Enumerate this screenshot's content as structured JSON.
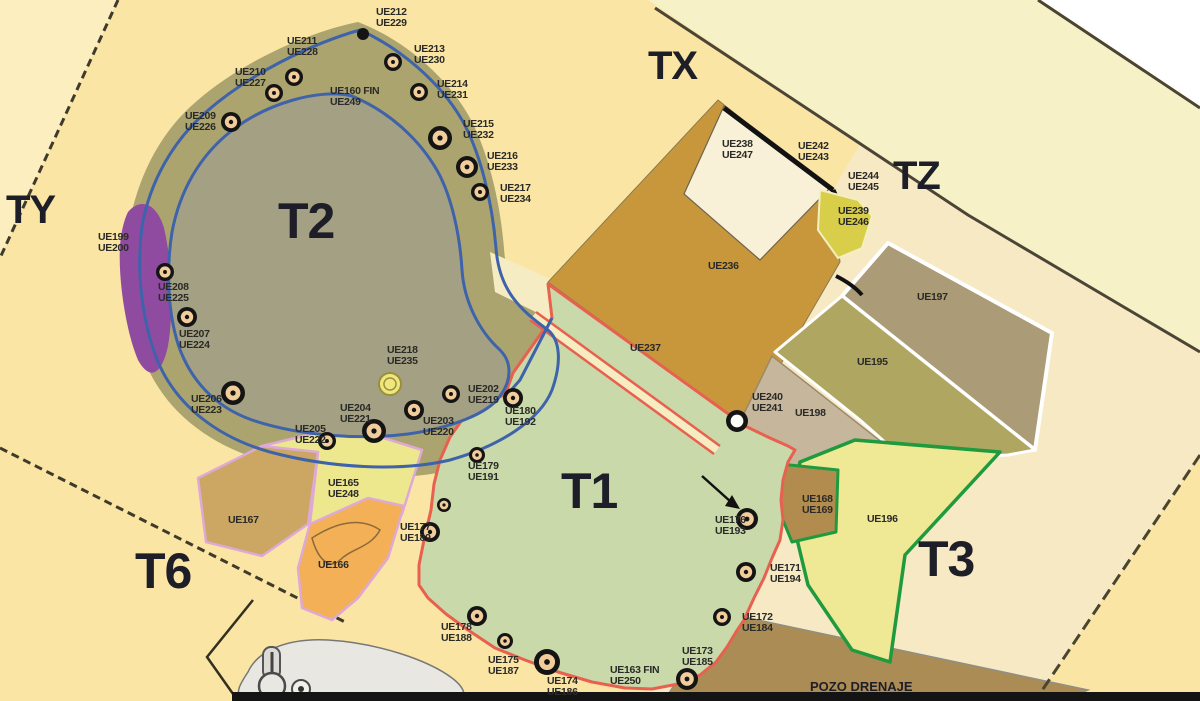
{
  "map": {
    "title": "archaeological-excavation-plan",
    "palette": {
      "background": "#FBE5A4",
      "background_light": "#FCEEBF",
      "outer_band": "#F6F1C6",
      "cream_area": "#F8E9C5",
      "t2_olive": "#ACA46E",
      "t2_inner": "#A4A083",
      "t2_outline_blue": "#3E63AA",
      "t1_green": "#C9D9A9",
      "t1_outline_red": "#E8604F",
      "purple_patch": "#8F4B9F",
      "ue236_gold": "#C9973B",
      "ue197_brown": "#AB9B76",
      "ue195_olive": "#AFA661",
      "ue198_tan": "#C6B69C",
      "ue196_yellow": "#EFE895",
      "green_outline": "#1F9A3F",
      "ue168_brown": "#B28C4E",
      "pozo_brown": "#AC8C55",
      "ue167_tan": "#CBA763",
      "ue165_yellow": "#EDE88E",
      "ue166_orange": "#F4B057",
      "pink_outline": "#DDA9D6",
      "feature_fill": "#F2CD9C",
      "label_color": "#2A2A28"
    },
    "zone_labels": [
      {
        "label": "T1",
        "x": 561,
        "y": 468,
        "size": 50
      },
      {
        "label": "T2",
        "x": 278,
        "y": 198,
        "size": 50
      },
      {
        "label": "T3",
        "x": 918,
        "y": 536,
        "size": 50
      },
      {
        "label": "T6",
        "x": 135,
        "y": 548,
        "size": 50
      },
      {
        "label": "TX",
        "x": 648,
        "y": 48,
        "size": 40
      },
      {
        "label": "TY",
        "x": 6,
        "y": 192,
        "size": 40
      },
      {
        "label": "TZ",
        "x": 893,
        "y": 158,
        "size": 40
      },
      {
        "label": "POZO DRENAJE",
        "x": 810,
        "y": 681,
        "size": 13
      }
    ],
    "unit_labels": [
      {
        "lines": [
          "UE212",
          "UE229"
        ],
        "x": 376,
        "y": 7
      },
      {
        "lines": [
          "UE211",
          "UE228"
        ],
        "x": 287,
        "y": 36
      },
      {
        "lines": [
          "UE210",
          "UE227"
        ],
        "x": 235,
        "y": 67
      },
      {
        "lines": [
          "UE209",
          "UE226"
        ],
        "x": 185,
        "y": 111
      },
      {
        "lines": [
          "UE213",
          "UE230"
        ],
        "x": 414,
        "y": 44
      },
      {
        "lines": [
          "UE214",
          "UE231"
        ],
        "x": 437,
        "y": 79
      },
      {
        "lines": [
          "UE160 FIN",
          "UE249"
        ],
        "x": 330,
        "y": 86
      },
      {
        "lines": [
          "UE215",
          "UE232"
        ],
        "x": 463,
        "y": 119
      },
      {
        "lines": [
          "UE216",
          "UE233"
        ],
        "x": 487,
        "y": 151
      },
      {
        "lines": [
          "UE217",
          "UE234"
        ],
        "x": 500,
        "y": 183
      },
      {
        "lines": [
          "UE199",
          "UE200"
        ],
        "x": 98,
        "y": 232
      },
      {
        "lines": [
          "UE208",
          "UE225"
        ],
        "x": 158,
        "y": 282
      },
      {
        "lines": [
          "UE207",
          "UE224"
        ],
        "x": 179,
        "y": 329
      },
      {
        "lines": [
          "UE206",
          "UE223"
        ],
        "x": 191,
        "y": 394
      },
      {
        "lines": [
          "UE218",
          "UE235"
        ],
        "x": 387,
        "y": 345
      },
      {
        "lines": [
          "UE204",
          "UE221"
        ],
        "x": 340,
        "y": 403
      },
      {
        "lines": [
          "UE205",
          "UE222"
        ],
        "x": 295,
        "y": 424
      },
      {
        "lines": [
          "UE203",
          "UE220"
        ],
        "x": 423,
        "y": 416
      },
      {
        "lines": [
          "UE202",
          "UE219"
        ],
        "x": 468,
        "y": 384
      },
      {
        "lines": [
          "UE180",
          "UE192"
        ],
        "x": 505,
        "y": 406
      },
      {
        "lines": [
          "UE179",
          "UE191"
        ],
        "x": 468,
        "y": 461
      },
      {
        "lines": [
          "UE177",
          "UE189"
        ],
        "x": 400,
        "y": 522
      },
      {
        "lines": [
          "UE178",
          "UE188"
        ],
        "x": 441,
        "y": 622
      },
      {
        "lines": [
          "UE175",
          "UE187"
        ],
        "x": 488,
        "y": 655
      },
      {
        "lines": [
          "UE174",
          "UE186"
        ],
        "x": 547,
        "y": 676
      },
      {
        "lines": [
          "UE163 FIN",
          "UE250"
        ],
        "x": 610,
        "y": 665
      },
      {
        "lines": [
          "UE173",
          "UE185"
        ],
        "x": 682,
        "y": 646
      },
      {
        "lines": [
          "UE172",
          "UE184"
        ],
        "x": 742,
        "y": 612
      },
      {
        "lines": [
          "UE171",
          "UE194"
        ],
        "x": 770,
        "y": 563
      },
      {
        "lines": [
          "UE176",
          "UE193"
        ],
        "x": 715,
        "y": 515
      },
      {
        "lines": [
          "UE165",
          "UE248"
        ],
        "x": 328,
        "y": 478
      },
      {
        "lines": [
          "UE167"
        ],
        "x": 228,
        "y": 515
      },
      {
        "lines": [
          "UE166"
        ],
        "x": 318,
        "y": 560
      },
      {
        "lines": [
          "UE236"
        ],
        "x": 708,
        "y": 261
      },
      {
        "lines": [
          "UE237"
        ],
        "x": 630,
        "y": 343
      },
      {
        "lines": [
          "UE238",
          "UE247"
        ],
        "x": 722,
        "y": 139
      },
      {
        "lines": [
          "UE242",
          "UE243"
        ],
        "x": 798,
        "y": 141
      },
      {
        "lines": [
          "UE244",
          "UE245"
        ],
        "x": 848,
        "y": 171
      },
      {
        "lines": [
          "UE239",
          "UE246"
        ],
        "x": 838,
        "y": 206
      },
      {
        "lines": [
          "UE197"
        ],
        "x": 917,
        "y": 292
      },
      {
        "lines": [
          "UE195"
        ],
        "x": 857,
        "y": 357
      },
      {
        "lines": [
          "UE240",
          "UE241"
        ],
        "x": 752,
        "y": 392
      },
      {
        "lines": [
          "UE198"
        ],
        "x": 795,
        "y": 408
      },
      {
        "lines": [
          "UE168",
          "UE169"
        ],
        "x": 802,
        "y": 494
      },
      {
        "lines": [
          "UE196"
        ],
        "x": 867,
        "y": 514
      }
    ],
    "features": [
      {
        "x": 363,
        "y": 34,
        "r": 6,
        "style": "dot"
      },
      {
        "x": 294,
        "y": 77,
        "r": 9,
        "style": "ring"
      },
      {
        "x": 274,
        "y": 93,
        "r": 9,
        "style": "ring"
      },
      {
        "x": 231,
        "y": 122,
        "r": 10,
        "style": "ring"
      },
      {
        "x": 393,
        "y": 62,
        "r": 9,
        "style": "ring"
      },
      {
        "x": 419,
        "y": 92,
        "r": 9,
        "style": "ring"
      },
      {
        "x": 440,
        "y": 138,
        "r": 12,
        "style": "ring"
      },
      {
        "x": 467,
        "y": 167,
        "r": 11,
        "style": "ring"
      },
      {
        "x": 480,
        "y": 192,
        "r": 9,
        "style": "ring"
      },
      {
        "x": 165,
        "y": 272,
        "r": 9,
        "style": "ring"
      },
      {
        "x": 187,
        "y": 317,
        "r": 10,
        "style": "ring"
      },
      {
        "x": 233,
        "y": 393,
        "r": 12,
        "style": "ring"
      },
      {
        "x": 327,
        "y": 441,
        "r": 9,
        "style": "ring"
      },
      {
        "x": 374,
        "y": 431,
        "r": 12,
        "style": "ring"
      },
      {
        "x": 414,
        "y": 410,
        "r": 10,
        "style": "ring"
      },
      {
        "x": 451,
        "y": 394,
        "r": 9,
        "style": "ring"
      },
      {
        "x": 513,
        "y": 398,
        "r": 10,
        "style": "ring"
      },
      {
        "x": 390,
        "y": 384,
        "r": 11,
        "style": "yellow"
      },
      {
        "x": 477,
        "y": 455,
        "r": 8,
        "style": "ring"
      },
      {
        "x": 444,
        "y": 505,
        "r": 7,
        "style": "ring"
      },
      {
        "x": 430,
        "y": 532,
        "r": 10,
        "style": "ring"
      },
      {
        "x": 477,
        "y": 616,
        "r": 10,
        "style": "ring"
      },
      {
        "x": 505,
        "y": 641,
        "r": 8,
        "style": "ring"
      },
      {
        "x": 547,
        "y": 662,
        "r": 13,
        "style": "ring"
      },
      {
        "x": 687,
        "y": 679,
        "r": 11,
        "style": "ring"
      },
      {
        "x": 722,
        "y": 617,
        "r": 9,
        "style": "ring"
      },
      {
        "x": 746,
        "y": 572,
        "r": 10,
        "style": "ring"
      },
      {
        "x": 747,
        "y": 519,
        "r": 11,
        "style": "ring"
      },
      {
        "x": 737,
        "y": 421,
        "r": 11,
        "style": "white"
      }
    ],
    "icons": [
      {
        "name": "pointer-arrow-icon"
      },
      {
        "name": "well-machinery-icon"
      }
    ]
  }
}
